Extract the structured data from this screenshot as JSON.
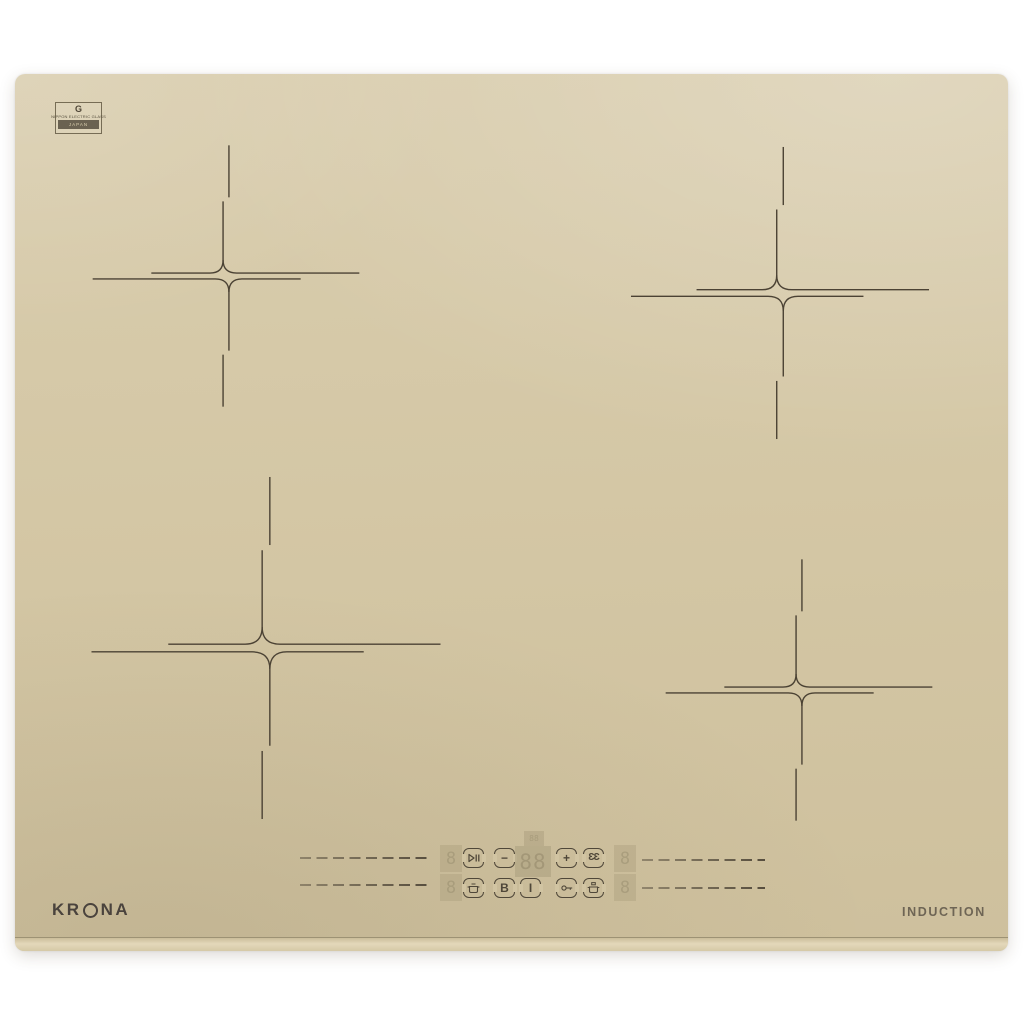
{
  "appliance": {
    "type": "induction cooktop",
    "brand_prefix": "KR",
    "brand_suffix": "NA",
    "brand_name": "KRONA",
    "induction_label": "INDUCTION"
  },
  "badge": {
    "logo_glyph": "G",
    "maker_line": "NIPPON ELECTRIC GLASS",
    "country_band": "JAPAN"
  },
  "panel": {
    "displays": {
      "main_value": "88",
      "aux_value": "88",
      "zone_left_upper": "8",
      "zone_left_lower": "8",
      "zone_right_upper": "8",
      "zone_right_lower": "8"
    },
    "buttons": {
      "minus": "−",
      "plus": "+",
      "boost": "B",
      "power": "I",
      "timer": "ƐƐ"
    },
    "icon_names": [
      "play-pause-icon",
      "keep-warm-pot-icon",
      "child-lock-key-icon",
      "auto-program-pot-icon"
    ]
  },
  "zones": {
    "count": 4,
    "marker_style": "offset cross with rounded center fillets"
  },
  "colors": {
    "glass": "#d3c6a4",
    "marker_line": "#4b4234",
    "control_ink": "#4f4739",
    "logo_ink": "#4a433d",
    "induction_ink": "#6e6555",
    "badge_band": "#6a6251"
  }
}
